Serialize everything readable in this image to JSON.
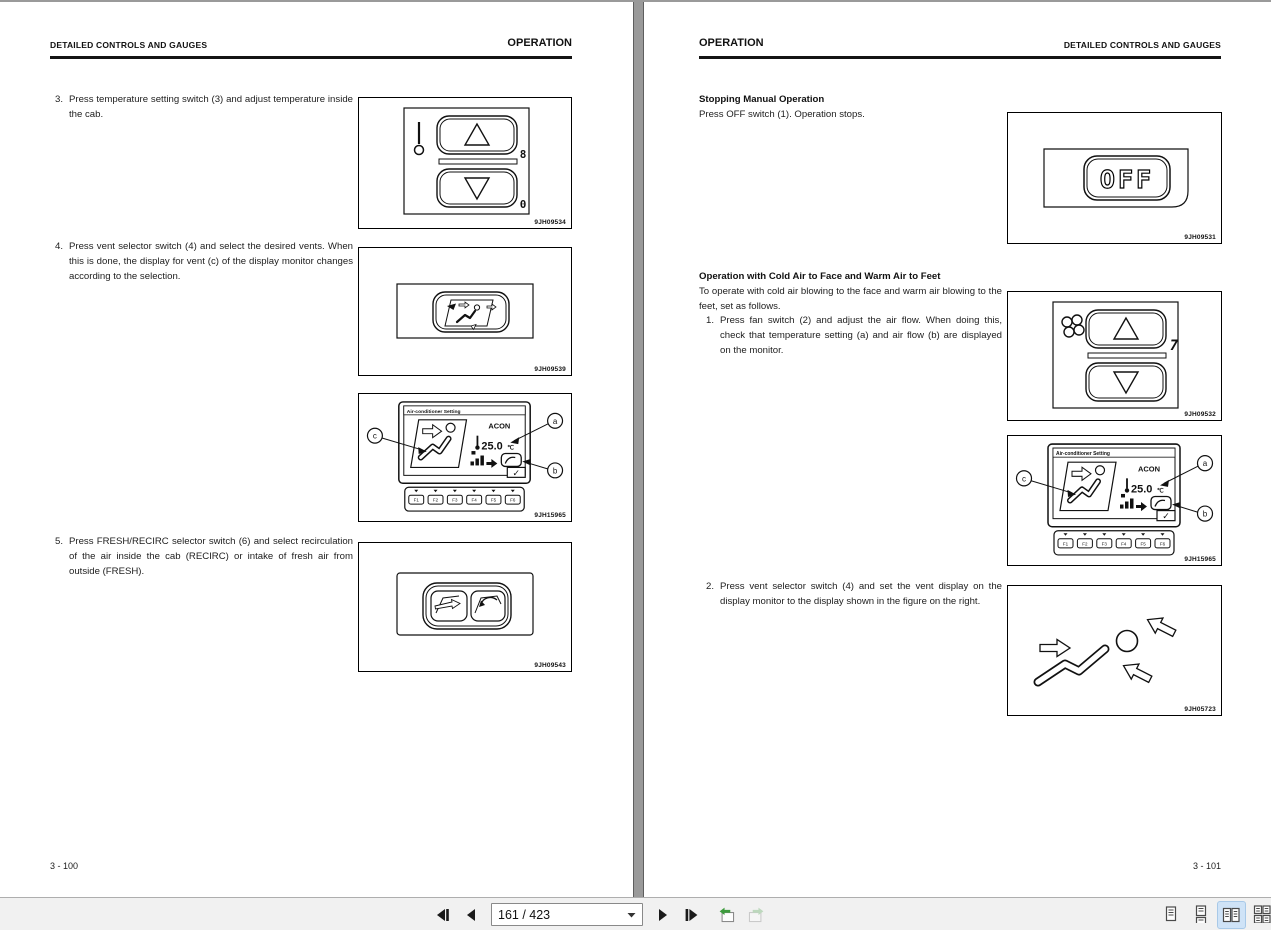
{
  "viewer": {
    "page_indicator": "161 / 423",
    "toolbar_bg": "#f1f1f1",
    "active_view_highlight": "#cfe3f7",
    "background_color": "#9a9a9a"
  },
  "left_page": {
    "header_left": "DETAILED CONTROLS AND GAUGES",
    "header_right": "OPERATION",
    "steps": [
      {
        "num": "3.",
        "text": "Press temperature setting switch (3) and adjust temperature inside the cab."
      },
      {
        "num": "4.",
        "text": "Press vent selector switch (4) and select the desired vents. When this is done, the display for vent (c) of the display monitor changes according to the selection."
      },
      {
        "num": "5.",
        "text": "Press FRESH/RECIRC selector switch (6) and select recirculation of the air inside the cab (RECIRC) or intake of fresh air from outside (FRESH)."
      }
    ],
    "figure_codes": {
      "temp_switch": "9JH09534",
      "vent_switch": "9JH09539",
      "monitor": "9JH15965",
      "fresh_recirc": "9JH09543"
    },
    "page_number": "3 - 100"
  },
  "right_page": {
    "header_left": "OPERATION",
    "header_right": "DETAILED CONTROLS AND GAUGES",
    "section1": {
      "heading": "Stopping Manual Operation",
      "body": "Press OFF switch (1).  Operation stops."
    },
    "section2": {
      "heading": "Operation with Cold Air to Face and Warm Air to Feet",
      "intro": "To operate with cold air blowing to the face and warm air blowing to the feet, set as follows.",
      "steps": [
        {
          "num": "1.",
          "text": "Press fan switch (2) and adjust the air flow. When doing this, check that temperature setting (a) and air flow (b) are displayed on the monitor."
        },
        {
          "num": "2.",
          "text": "Press vent selector switch (4) and set the vent display on the display monitor to the display shown in the figure on the right."
        }
      ]
    },
    "figure_codes": {
      "off_switch": "9JH09531",
      "fan_switch": "9JH09532",
      "monitor": "9JH15965",
      "vent_display": "9JH05723"
    },
    "page_number": "3 - 101"
  },
  "monitor": {
    "title": "Air-conditioner Setting",
    "acon_label": "ACON",
    "temp_value": "25.0",
    "temp_unit": "℃",
    "check_glyph": "✓",
    "callouts": [
      "a",
      "b",
      "c"
    ],
    "function_keys": [
      "F1",
      "F2",
      "F3",
      "F4",
      "F5",
      "F6"
    ]
  },
  "controls": {
    "temp_upper_glyph": "8",
    "temp_lower_glyph": "0",
    "fan_level": "7",
    "off_label": "OFF"
  }
}
